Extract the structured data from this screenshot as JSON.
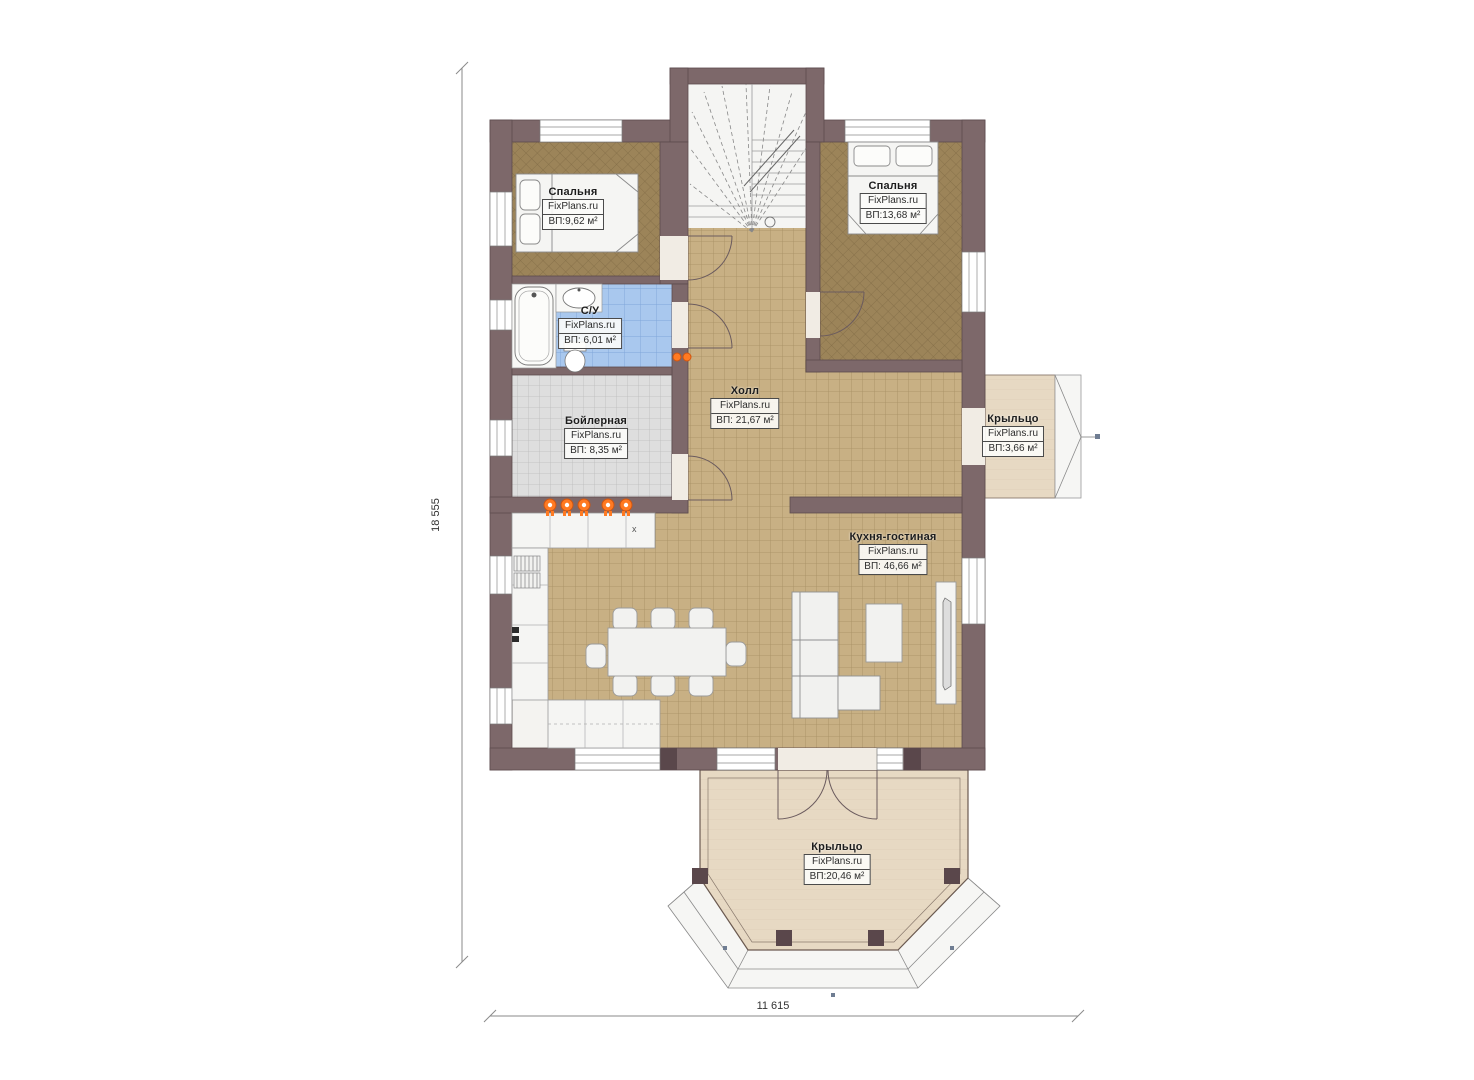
{
  "plan": {
    "watermark": "FixPlans.ru",
    "rooms": [
      {
        "id": "bedroom-left",
        "name": "Спальня",
        "area": "ВП:9,62 м²"
      },
      {
        "id": "bedroom-right",
        "name": "Спальня",
        "area": "ВП:13,68 м²"
      },
      {
        "id": "bathroom",
        "name": "С/У",
        "area": "ВП: 6,01 м²"
      },
      {
        "id": "boiler-room",
        "name": "Бойлерная",
        "area": "ВП: 8,35 м²"
      },
      {
        "id": "hall",
        "name": "Холл",
        "area": "ВП: 21,67 м²"
      },
      {
        "id": "kitchen-living",
        "name": "Кухня-гостиная",
        "area": "ВП: 46,66 м²"
      },
      {
        "id": "porch-right",
        "name": "Крыльцо",
        "area": "ВП:3,66 м²"
      },
      {
        "id": "porch-bottom",
        "name": "Крыльцо",
        "area": "ВП:20,46 м²"
      }
    ],
    "dimensions": {
      "vertical": "18 555",
      "horizontal": "11 615"
    },
    "colors": {
      "wall": "#7d686a",
      "tile_floor": "#c8b084",
      "bedroom_floor": "#9c8459",
      "bath_floor": "#a9c8ee",
      "boiler_floor": "#dedede",
      "porch_floor": "#e7d9c3",
      "accent_orange": "#ff7a22"
    }
  }
}
